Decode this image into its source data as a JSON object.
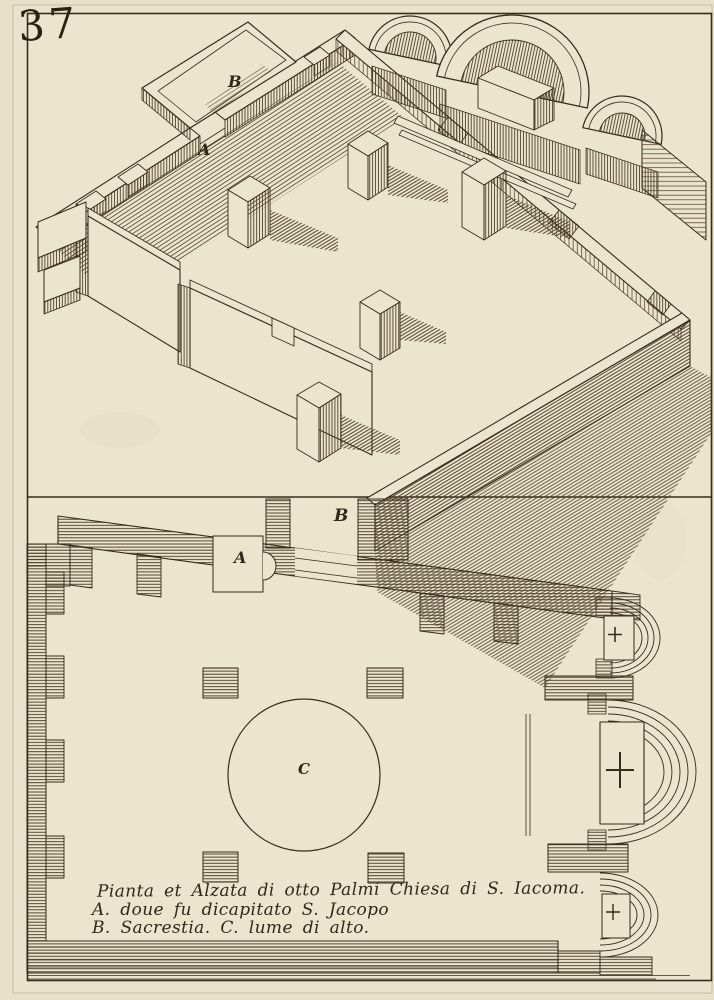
{
  "plate": {
    "number": "37"
  },
  "caption": {
    "line1": "Pianta et Alzata di otto Palmi Chiesa di S. Iacoma.",
    "line2": "A. doue fu dicapitato S. Jacopo",
    "line3": "B. Sacrestia. C. lume di alto."
  },
  "elevation_labels": {
    "a": "A",
    "b": "B"
  },
  "plan_labels": {
    "a": "A",
    "b": "B",
    "c": "C"
  },
  "colors": {
    "paper": "#ece5cd",
    "margin_paper": "#e8e1ca",
    "ink": "#362c1c",
    "hatch": "#53452e"
  }
}
